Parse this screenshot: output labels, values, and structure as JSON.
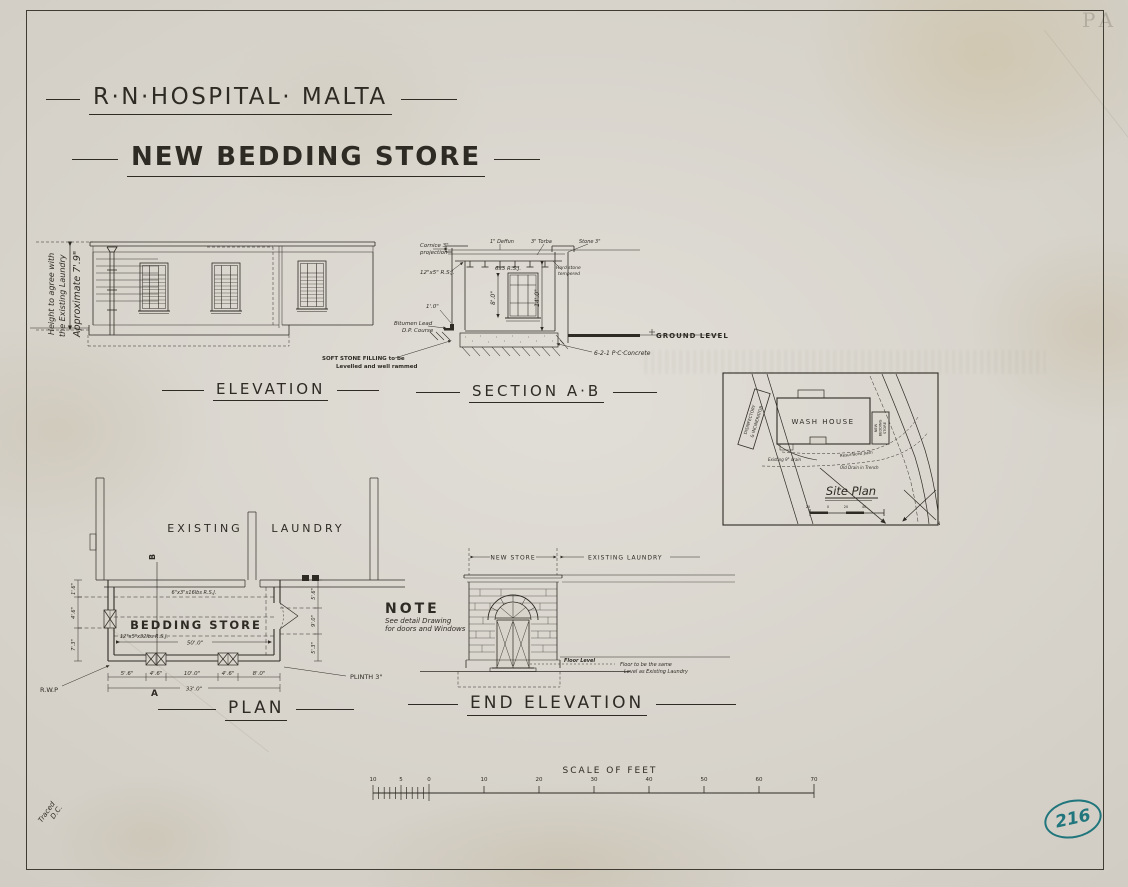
{
  "meta": {
    "title": "R·N·HOSPITAL· MALTA",
    "subtitle": "NEW BEDDING STORE",
    "plan_number": "216",
    "traced": "Traced",
    "initials": "D.C.",
    "corner_mark": "PA",
    "ink_color": "#2e2b24",
    "stamp_color": "#20767c"
  },
  "elevation": {
    "label": "ELEVATION",
    "note1": "Height to agree with",
    "note2": "the Existing Laundry",
    "note3": "Approximate 7'.9\""
  },
  "section": {
    "label": "SECTION A·B",
    "cornice1": "Cornice 3\"",
    "cornice2": "projection",
    "rsj_main": "12\"x5\" R.S.J.",
    "deffun": "1\" Deffun",
    "torba": "3\" Torba",
    "stone": "Stone 3\"",
    "rsj_joists": "6x3 R.S.J.",
    "hard1": "Hard stone",
    "hard2": "tempered",
    "dim_window": "8'.0\"",
    "dim_wall": "14'.0\"",
    "dim_base": "1'.0\"",
    "bitumen1": "Bitumen Lead",
    "bitumen2": "D.P. Course",
    "filling1": "SOFT STONE FILLING to be",
    "filling2": "Levelled and well rammed",
    "concrete": "6-2-1 P·C·Concrete",
    "ground": "GROUND LEVEL"
  },
  "plan": {
    "label": "PLAN",
    "existing": "EXISTING",
    "laundry": "LAUNDRY",
    "room": "BEDDING STORE",
    "rsj_top": "6\"x3\"x16lbs R.S.J.",
    "rsj_mid": "12\"x5\"x32lbs R.S.J.",
    "marker_a": "A",
    "marker_b": "B",
    "rwp": "R.W.P",
    "plinth": "PLINTH 3\"",
    "dim_width": "50'.0\"",
    "dim_total": "33'.0\"",
    "bottom": [
      "5'.6\"",
      "4'.6\"",
      "10'.0\"",
      "4'.6\"",
      "8'.0\""
    ],
    "left": [
      "1'.6\"",
      "4'.6\"",
      "7'.3\""
    ],
    "right": [
      "5'.6\"",
      "9'.0\"",
      "5'.3\""
    ]
  },
  "end_elevation": {
    "label": "END ELEVATION",
    "new_store": "NEW STORE",
    "existing_laundry": "EXISTING LAUNDRY",
    "floor_level": "Floor Level",
    "floor1": "Floor to be the same",
    "floor2": "Level as Existing Laundry",
    "note_title": "NOTE",
    "note1": "See detail Drawing",
    "note2": "for doors and Windows"
  },
  "site": {
    "label": "Site Plan",
    "wash_house": "WASH HOUSE",
    "store1": "NEW",
    "store2": "BEDDING",
    "store3": "STORE",
    "dis1": "DISINFECTORY",
    "dis2": "& INCINERATOR",
    "drain": "Existing 9\" drain",
    "path": "Resurfaced path",
    "old_drain": "Old Drain in Trench",
    "north": "N",
    "ticks": [
      "20",
      "0",
      "20",
      "40"
    ]
  },
  "feet": {
    "title": "SCALE OF FEET",
    "left": [
      "10",
      "5",
      "0"
    ],
    "major": [
      "10",
      "20",
      "30",
      "40",
      "50",
      "60",
      "70"
    ]
  }
}
